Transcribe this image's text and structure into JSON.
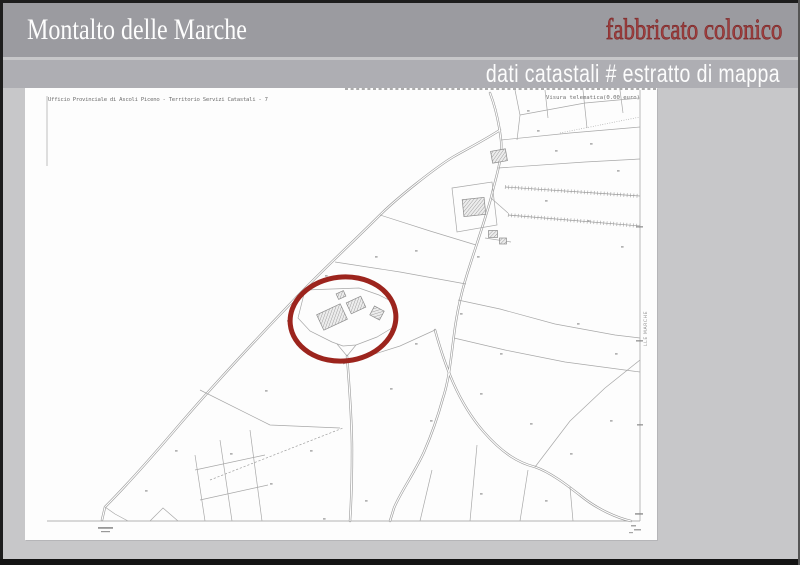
{
  "header": {
    "municipality": "Montalto delle Marche",
    "property_title": "fabbricato colonico",
    "subtitle": "dati catastali # estratto di mappa"
  },
  "map": {
    "header_left": "Ufficio Provinciale di Ascoli Piceno - Territorio Servizi Catastali - 7",
    "header_right": "Visura telematica(0.00 euro)",
    "margin_vertical_label": "LLE MARCHE"
  },
  "colors": {
    "band_dark": "#9b9ba0",
    "band_light": "#aeaeb3",
    "background": "#c7c7c9",
    "page": "#fdfdfd",
    "title_red": "#a04040",
    "highlight_red": "#9c241d",
    "map_line": "#a6a6a6"
  }
}
